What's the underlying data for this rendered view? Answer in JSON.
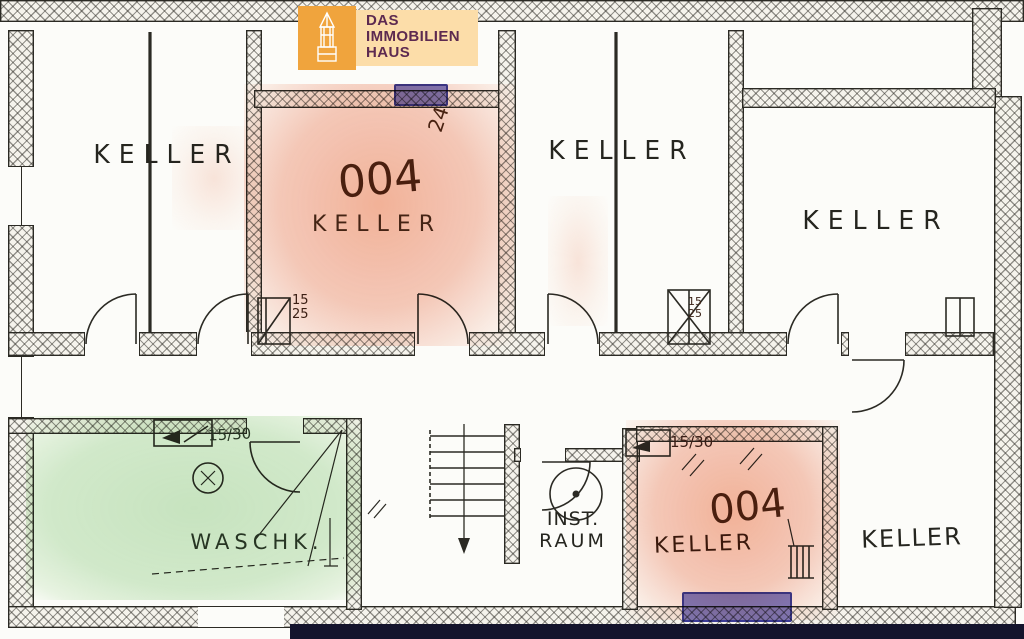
{
  "logo": {
    "line1": "DAS",
    "line2": "IMMOBILIEN",
    "line3": "HAUS"
  },
  "rooms": {
    "keller_top_left": "KELLER",
    "keller_top_middle": "KELLER",
    "keller_top_right": "KELLER",
    "keller_bottom_right": "KELLER",
    "waschkueche": "WASCHK.",
    "inst_raum_line1": "INST.",
    "inst_raum_line2": "RAUM",
    "unit_top": {
      "number": "004",
      "label": "KELLER"
    },
    "unit_bottom": {
      "number": "004",
      "label": "KELLER"
    }
  },
  "annotations": {
    "window_width_top": "24",
    "door_dim_top": "15\n25",
    "shaft_dim_middle": "15\n25",
    "window_dim_waschk": "15/30",
    "window_dim_unit_bottom": "15/30"
  },
  "colors": {
    "highlight_salmon": "#f5c0ac",
    "highlight_green": "#cbe6c4",
    "highlight_window_blue": "#8585d4",
    "logo_orange": "#f0a43d",
    "logo_panel": "#fcdda9",
    "logo_text": "#5d2a50",
    "ink": "#2b2a24"
  }
}
